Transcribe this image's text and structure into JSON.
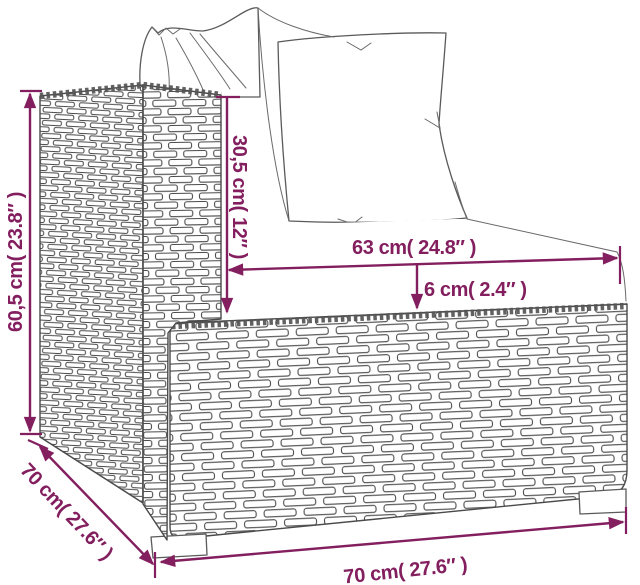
{
  "diagram": {
    "accent_color": "#831e5f",
    "sketch_color": "#4d4d4d",
    "background_color": "#ffffff",
    "dimensions": {
      "total_height": {
        "label": "60,5 cm( 23.8″ )"
      },
      "back_height": {
        "label": "30,5 cm( 12″ )"
      },
      "seat_width": {
        "label": "63 cm( 24.8″ )"
      },
      "seat_thickness": {
        "label": "6 cm( 2.4″ )"
      },
      "depth": {
        "label": "70 cm( 27.6″ )"
      },
      "total_width": {
        "label": "70 cm( 27.6″ )"
      }
    }
  }
}
